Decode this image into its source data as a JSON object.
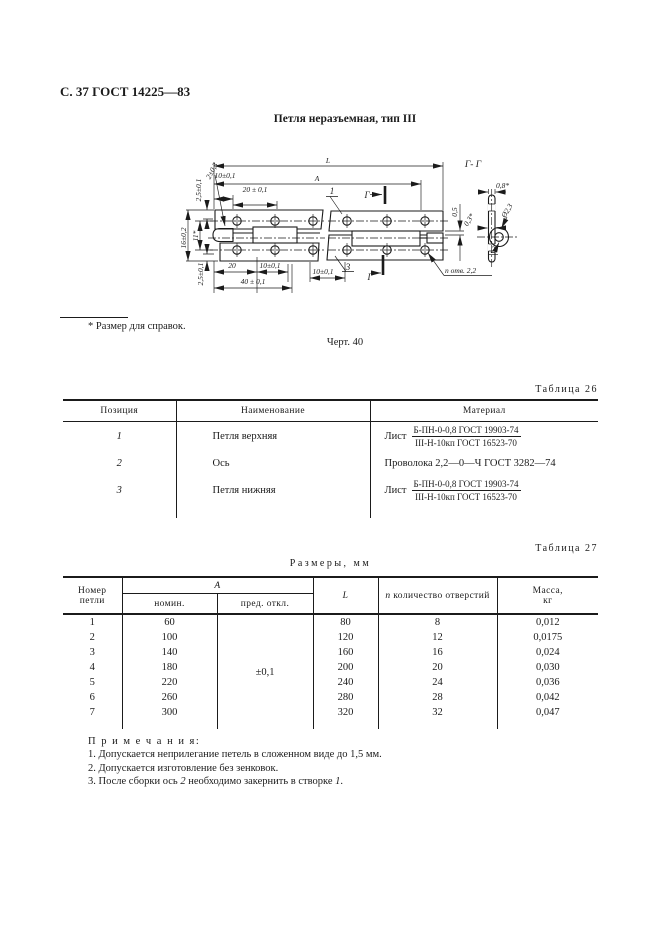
{
  "page": {
    "header": "С. 37 ГОСТ 14225—83",
    "title": "Петля неразъемная, тип III",
    "footnote": "* Размер для справок.",
    "figure_caption": "Черт. 40"
  },
  "drawing": {
    "labels": {
      "l": "L",
      "a": "А",
      "d10_top": "10±0,1",
      "d20_top": "20 ± 0,1",
      "d2": "2±0,3",
      "d25_top": "2,5±0,1",
      "d16": "16±0,2",
      "d11": "11*",
      "d25_bot": "2,5±0,1",
      "d20_bot": "20",
      "d10_bot": "10±0,1",
      "d40": "40 ± 0,1",
      "d10_right": "10±0,1",
      "d05": "0,5",
      "d08": "0,8*",
      "d23": "Ø2,3",
      "d03": "0,3*",
      "part1": "1",
      "part2": "2",
      "part3": "3",
      "g_top": "Г",
      "g_bottom": "Г",
      "section_title": "Г- Г",
      "holes": "п отв. 2,2"
    }
  },
  "table26": {
    "caption": "Таблица 26",
    "col_pos": "Позиция",
    "col_name": "Наименование",
    "col_mat": "Материал",
    "rows": [
      {
        "pos": "1",
        "name": "Петля верхняя",
        "mat_word": "Лист",
        "mat_num": "Б-ПН-0-0,8 ГОСТ 19903-74",
        "mat_den": "III-Н-10кп ГОСТ 16523-70"
      },
      {
        "pos": "2",
        "name": "Ось",
        "mat": "Проволока 2,2—0—Ч ГОСТ 3282—74"
      },
      {
        "pos": "3",
        "name": "Петля нижняя",
        "mat_word": "Лист",
        "mat_num": "Б-ПН-0-0,8 ГОСТ 19903-74",
        "mat_den": "III-Н-10кп ГОСТ 16523-70"
      }
    ]
  },
  "table27": {
    "caption": "Таблица 27",
    "title": "Размеры, мм",
    "col_nomer_1": "Номер",
    "col_nomer_2": "петли",
    "col_a": "А",
    "col_nominal": "номин.",
    "col_pred": "пред. откл.",
    "col_l": "L",
    "col_n_sym": "n",
    "col_n_text": "количество отверстий",
    "col_mass_1": "Масса,",
    "col_mass_2": "кг",
    "pred_value": "±0,1",
    "rows": [
      [
        "1",
        "60",
        "80",
        "8",
        "0,012"
      ],
      [
        "2",
        "100",
        "120",
        "12",
        "0,0175"
      ],
      [
        "3",
        "140",
        "160",
        "16",
        "0,024"
      ],
      [
        "4",
        "180",
        "200",
        "20",
        "0,030"
      ],
      [
        "5",
        "220",
        "240",
        "24",
        "0,036"
      ],
      [
        "6",
        "260",
        "280",
        "28",
        "0,042"
      ],
      [
        "7",
        "300",
        "320",
        "32",
        "0,047"
      ]
    ]
  },
  "notes": {
    "heading": "П р и м е ч а н и я:",
    "items": [
      "1. Допускается неприлегание петель в сложенном виде до 1,5 мм.",
      "2. Допускается изготовление без зенковок."
    ],
    "item3_parts": [
      "3. После сборки ось ",
      "2",
      " необходимо закернить в створке ",
      "1",
      "."
    ]
  }
}
